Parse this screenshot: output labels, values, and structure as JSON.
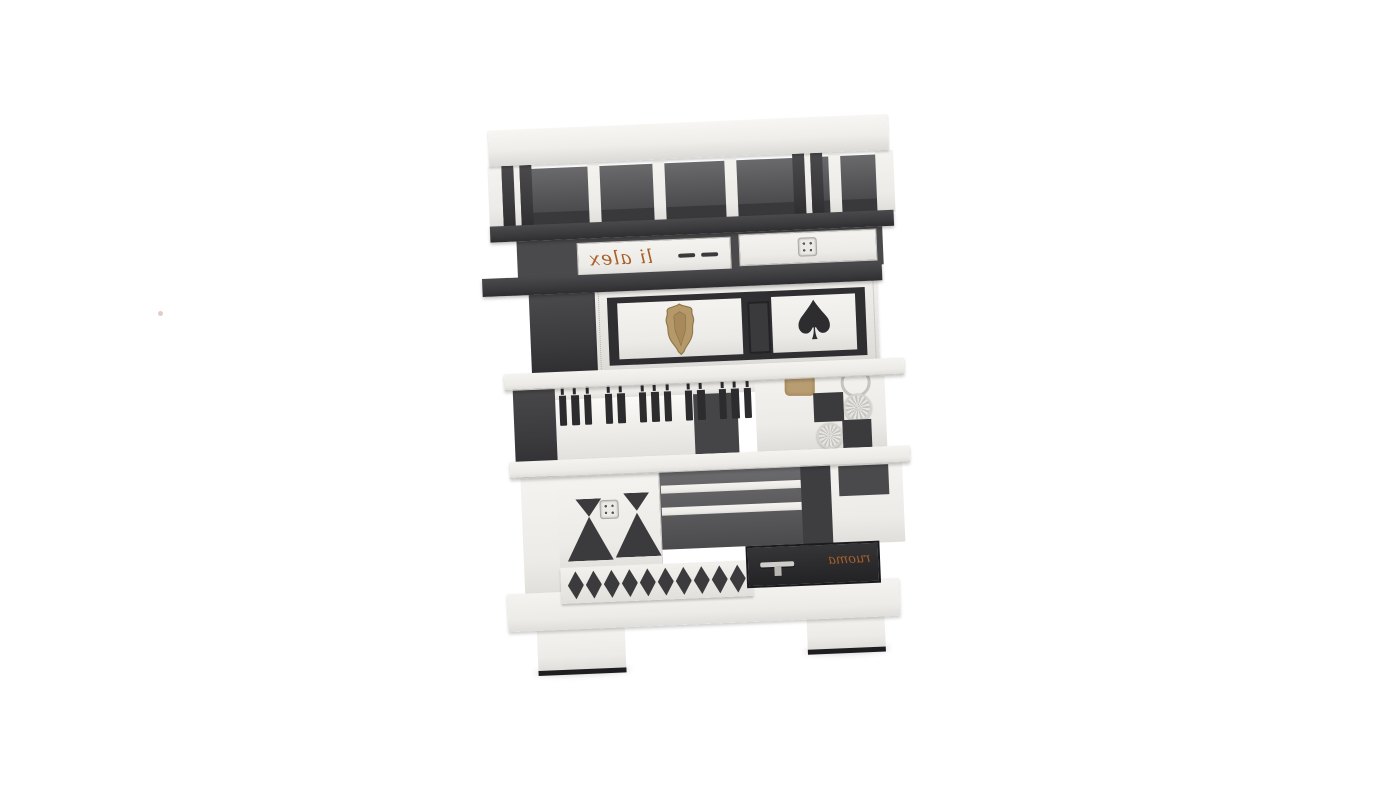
{
  "scene": {
    "description": "3D product render of an eclectic black-and-white patchwork bookcase cabinet on a plain white background",
    "background_color": "#ffffff"
  },
  "palette": {
    "white_wood": "#efeeeb",
    "white_wood_shade": "#dcdad6",
    "dark_wood": "#3b3b3d",
    "near_black": "#28282a",
    "interior_shadow": "#4e4e50",
    "gold_ornament": "#b5996b",
    "script_orange": "#a95f28",
    "silver_metal": "#cfcdc9"
  },
  "furniture": {
    "decor": {
      "top_drawer_script": "li alex",
      "bottom_drawer_script": "ruoma",
      "spade_glyph": "♠"
    },
    "piano_keys": {
      "groups": [
        3,
        2,
        3,
        2,
        3
      ]
    },
    "harlequin_diamonds": {
      "count": 10
    },
    "checkerboard": {
      "black_squares": 2,
      "carved_rosettes": 2
    },
    "top_cubbies": {
      "open_compartments": 5
    }
  },
  "artifact_dot": {
    "color": "#d9b7ae"
  }
}
